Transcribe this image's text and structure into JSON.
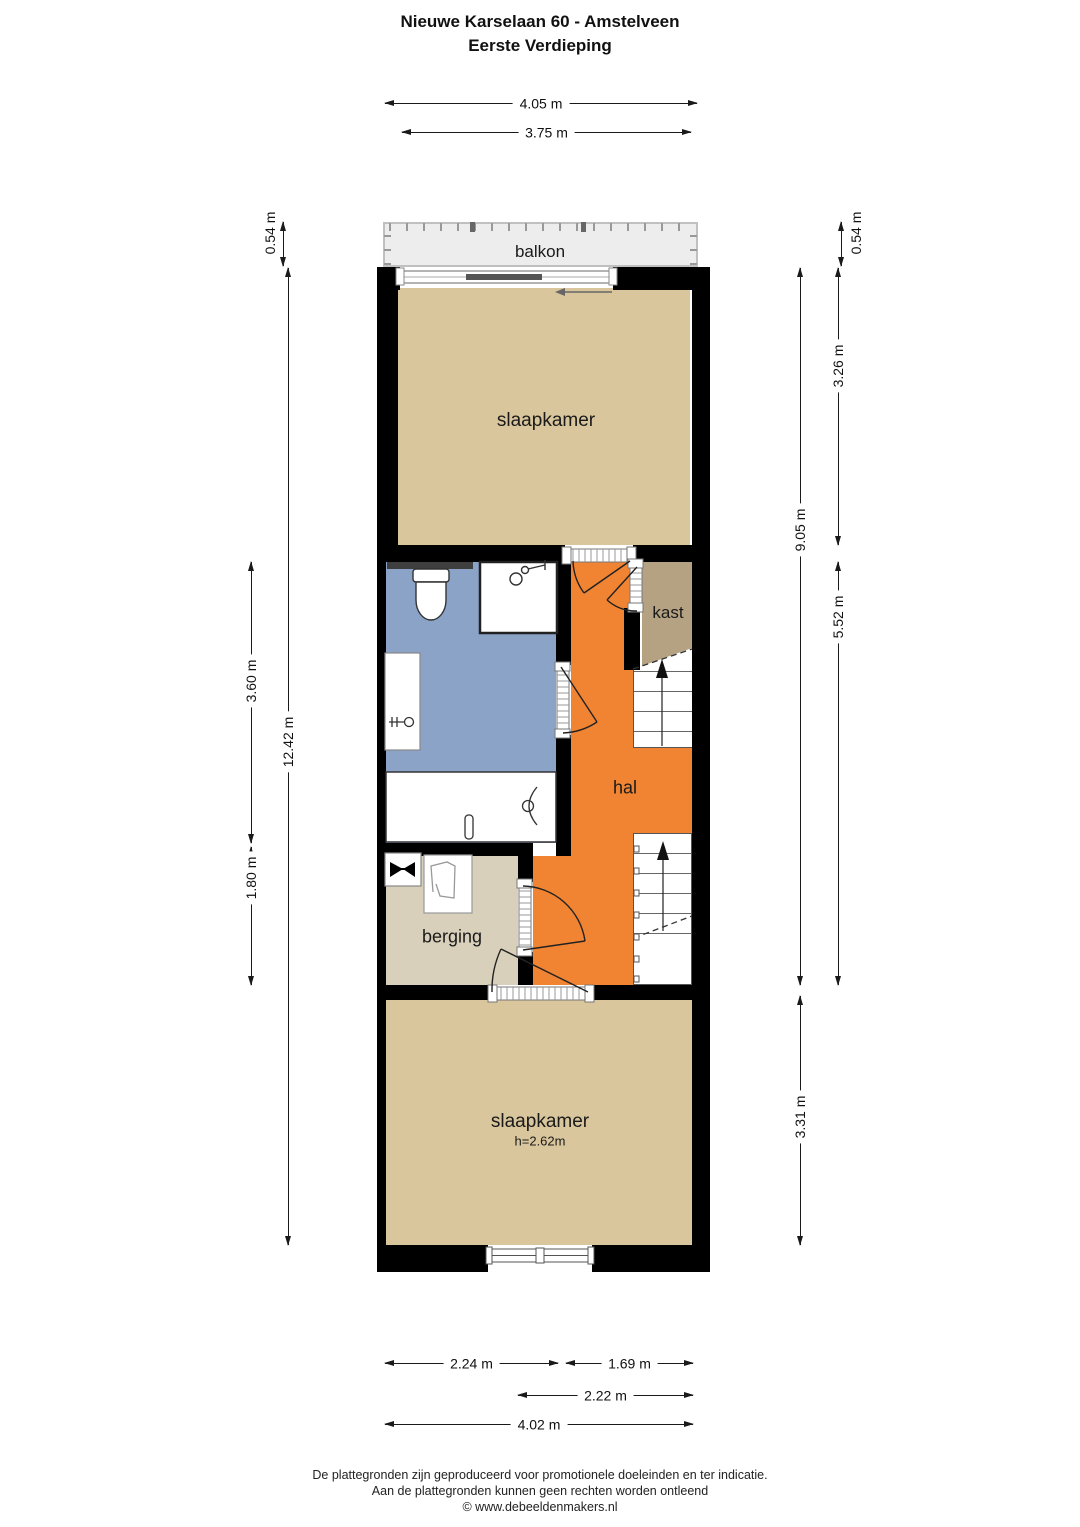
{
  "title": {
    "line1": "Nieuwe Karselaan 60 - Amstelveen",
    "line2": "Eerste Verdieping"
  },
  "rooms": {
    "balkon": "balkon",
    "slaapkamer_top": "slaapkamer",
    "kast": "kast",
    "hal": "hal",
    "berging": "berging",
    "slaapkamer_bottom": "slaapkamer",
    "slaapkamer_bottom_ceiling": "h=2.62m"
  },
  "dimensions": {
    "top_outer": "4.05 m",
    "top_inner": "3.75 m",
    "left_balcony": "0.54 m",
    "left_bathroom": "3.60 m",
    "left_total": "12.42 m",
    "left_berging": "1.80 m",
    "right_balcony": "0.54 m",
    "right_bedroom_top": "3.26 m",
    "right_total": "9.05 m",
    "right_hall": "5.52 m",
    "right_bedroom_bottom": "3.31 m",
    "bottom_left": "2.24 m",
    "bottom_right": "1.69 m",
    "bottom_hall": "2.22 m",
    "bottom_total": "4.02 m"
  },
  "footer": {
    "line1": "De plattegronden zijn geproduceerd voor promotionele doeleinden en ter indicatie.",
    "line2": "Aan de plattegronden kunnen geen rechten worden ontleend",
    "line3": "© www.debeeldenmakers.nl"
  },
  "colors": {
    "wall": "#000000",
    "bedroom": "#D9C69C",
    "bathroom": "#8CA3C8",
    "hall": "#F18433",
    "closet": "#B4A283",
    "storage": "#D8D0BA",
    "balcony": "#EDEDED"
  }
}
